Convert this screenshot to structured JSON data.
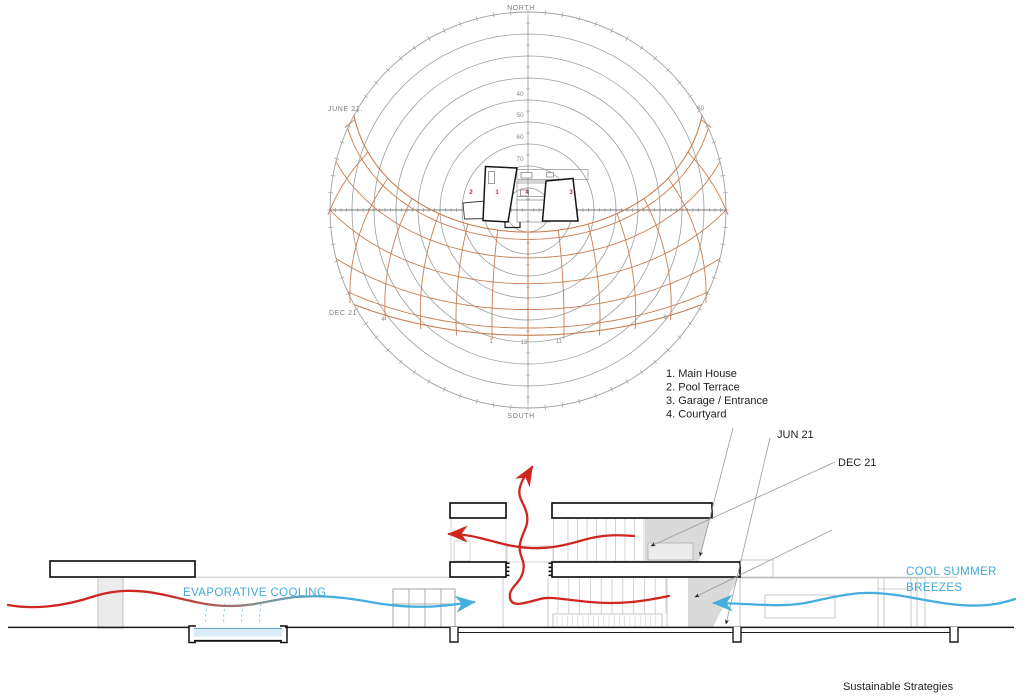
{
  "caption": "Sustainable Strategies",
  "sun_diagram": {
    "north": "NORTH",
    "south": "SOUTH",
    "june": "JUNE 21.",
    "dec": "DEC 21",
    "azimuth_60": "60",
    "altitude": {
      "a40": "40",
      "a50": "50",
      "a60": "60",
      "a70": "70"
    },
    "hours": {
      "h4": "4",
      "h1": "1",
      "h12": "12",
      "h11": "11",
      "h8": "8"
    },
    "plan": {
      "n1": "1",
      "n2": "2",
      "n3": "3",
      "n4": "4"
    }
  },
  "legend": {
    "items": [
      "1. Main House",
      "2. Pool Terrace",
      "3. Garage / Entrance",
      "4. Courtyard"
    ]
  },
  "section": {
    "jun": "JUN 21",
    "dec": "DEC 21",
    "evaporative": "EVAPORATIVE COOLING",
    "breezes1": "COOL SUMMER",
    "breezes2": "BREEZES"
  },
  "colors": {
    "sun_net": "#c87e52",
    "grid": "#9f9f9f",
    "axis": "#777777",
    "red": "#cf2620",
    "blue": "#45aede",
    "ink": "#1a1a1a",
    "light": "#c9c9c9",
    "fillgray": "#dadada"
  }
}
